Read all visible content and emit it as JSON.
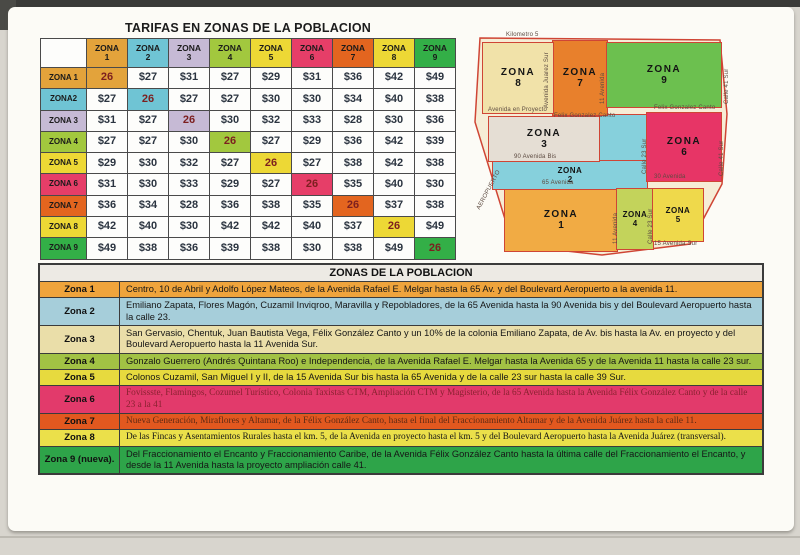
{
  "fare_table": {
    "title": "TARIFAS EN ZONAS DE LA POBLACION",
    "col_headers": [
      [
        "ZONA",
        "1"
      ],
      [
        "ZONA",
        "2"
      ],
      [
        "ZONA",
        "3"
      ],
      [
        "ZONA",
        "4"
      ],
      [
        "ZONA",
        "5"
      ],
      [
        "ZONA",
        "6"
      ],
      [
        "ZONA",
        "7"
      ],
      [
        "ZONA",
        "8"
      ],
      [
        "ZONA",
        "9"
      ]
    ],
    "row_headers": [
      "ZONA 1",
      "ZONA2",
      "ZONA 3",
      "ZONA 4",
      "ZONA 5",
      "ZONA 6",
      "ZONA 7",
      "ZONA 8",
      "ZONA 9"
    ],
    "zone_colors": [
      "#E3A33B",
      "#6FC4D4",
      "#C6BAD5",
      "#A2C83E",
      "#EDD835",
      "#E63E68",
      "#E3651F",
      "#EDD835",
      "#33AF47"
    ],
    "rows": [
      [
        "26",
        "$27",
        "$31",
        "$27",
        "$29",
        "$31",
        "$36",
        "$42",
        "$49"
      ],
      [
        "$27",
        "26",
        "$27",
        "$27",
        "$30",
        "$30",
        "$34",
        "$40",
        "$38"
      ],
      [
        "$31",
        "$27",
        "26",
        "$30",
        "$32",
        "$33",
        "$28",
        "$30",
        "$36"
      ],
      [
        "$27",
        "$27",
        "$30",
        "26",
        "$27",
        "$29",
        "$36",
        "$42",
        "$39"
      ],
      [
        "$29",
        "$30",
        "$32",
        "$27",
        "26",
        "$27",
        "$38",
        "$42",
        "$38"
      ],
      [
        "$31",
        "$30",
        "$33",
        "$29",
        "$27",
        "26",
        "$35",
        "$40",
        "$30"
      ],
      [
        "$36",
        "$34",
        "$28",
        "$36",
        "$38",
        "$35",
        "26",
        "$37",
        "$38"
      ],
      [
        "$42",
        "$40",
        "$30",
        "$42",
        "$42",
        "$40",
        "$37",
        "26",
        "$49"
      ],
      [
        "$49",
        "$38",
        "$36",
        "$39",
        "$38",
        "$30",
        "$38",
        "$49",
        "26"
      ]
    ]
  },
  "map": {
    "zones": [
      {
        "label": "ZONA",
        "num": "1",
        "color": "#F1AB44"
      },
      {
        "label": "ZONA",
        "num": "2",
        "color": "#86D0DC"
      },
      {
        "label": "ZONA",
        "num": "3",
        "color": "#E5DED4"
      },
      {
        "label": "ZONA",
        "num": "4",
        "color": "#C3D35B"
      },
      {
        "label": "ZONA",
        "num": "5",
        "color": "#EFD94B"
      },
      {
        "label": "ZONA",
        "num": "6",
        "color": "#E73566"
      },
      {
        "label": "ZONA",
        "num": "7",
        "color": "#E8802C"
      },
      {
        "label": "ZONA",
        "num": "8",
        "color": "#F1E2A9"
      },
      {
        "label": "ZONA",
        "num": "9",
        "color": "#6CC04F"
      }
    ],
    "streets": [
      {
        "text": "Kilometro 5"
      },
      {
        "text": "Avenida Juarez Sur"
      },
      {
        "text": "11 Avenida"
      },
      {
        "text": "Avenida en Proyecto"
      },
      {
        "text": "Felix Gonzalez Canto"
      },
      {
        "text": "Felix Gonzalez Canto"
      },
      {
        "text": "90 Avenida Bis"
      },
      {
        "text": "65 Avenida"
      },
      {
        "text": "30 Avenida"
      },
      {
        "text": "Calle 41 Sur"
      },
      {
        "text": "Calle 41 Sur"
      },
      {
        "text": "AEROPUERTO"
      },
      {
        "text": "15 Avenida Sur"
      },
      {
        "text": "Calle 23 Sur"
      },
      {
        "text": "Calle 23 Sur"
      },
      {
        "text": "11 Avenida"
      }
    ],
    "outline_color": "#cf4535",
    "ground_color": "#f6edd6"
  },
  "legend": {
    "title": "ZONAS DE LA POBLACION",
    "rows": [
      {
        "label": "Zona 1",
        "color": "#EFA43C",
        "text": "Centro, 10 de Abril y Adolfo López Mateos, de la Avenida Rafael E. Melgar hasta la 65 Av. y del Boulevard Aeropuerto a la avenida 11."
      },
      {
        "label": "Zona 2",
        "color": "#A6CEDA",
        "text": "Emiliano Zapata, Flores Magón, Cuzamil Inviqroo, Maravilla y Repobladores, de la 65 Avenida hasta la 90 Avenida bis y del Boulevard Aeropuerto hasta la calle 23."
      },
      {
        "label": "Zona 3",
        "color": "#EADEA9",
        "text": "San Gervasio, Chentuk, Juan Bautista Vega, Félix González Canto y un 10% de la colonia Emiliano Zapata, de Av. bis hasta la Av. en proyecto y del Boulevard Aeropuerto hasta la 11 Avenida Sur."
      },
      {
        "label": "Zona 4",
        "color": "#A2C244",
        "text": "Gonzalo Guerrero (Andrés Quintana Roo) e Independencia, de la Avenida Rafael E. Melgar hasta la Avenida 65 y de la Avenida 11 hasta la calle 23 sur."
      },
      {
        "label": "Zona 5",
        "color": "#E7DA3E",
        "text": "Colonos Cuzamil, San Miguel I y II, de la 15 Avenida Sur bis hasta la 65 Avenida y de la calle 23 sur hasta la calle 39 Sur."
      },
      {
        "label": "Zona 6",
        "color": "#E23A6B",
        "text": "Fovissste, Flamingos, Cozumel Turístico, Colonia Taxistas CTM, Ampliación CTM y Magisterio, de la 65 Avenida hasta la Avenida Félix González Canto y de la calle 23 a la 41"
      },
      {
        "label": "Zona 7",
        "color": "#E2581F",
        "text": "Nueva Generación, Miraflores y Altamar, de la Félix González Canto, hasta el final del Fraccionamiento Altamar y de la Avenida Juárez hasta la calle 11."
      },
      {
        "label": "Zona 8",
        "color": "#EBE04A",
        "text": "De las Fincas y Asentamientos Rurales hasta el km. 5, de la Avenida en proyecto hasta el km. 5 y del Boulevard Aeropuerto hasta la Avenida Juárez (transversal)."
      },
      {
        "label": "Zona 9 (nueva).",
        "color": "#2EA449",
        "text": "Del Fraccionamiento el Encanto y Fraccionamiento Caribe, de la Avenida Félix González Canto hasta la última calle del Fraccionamiento el Encanto, y desde la 11 Avenida hasta la proyecto ampliación calle 41."
      }
    ]
  }
}
